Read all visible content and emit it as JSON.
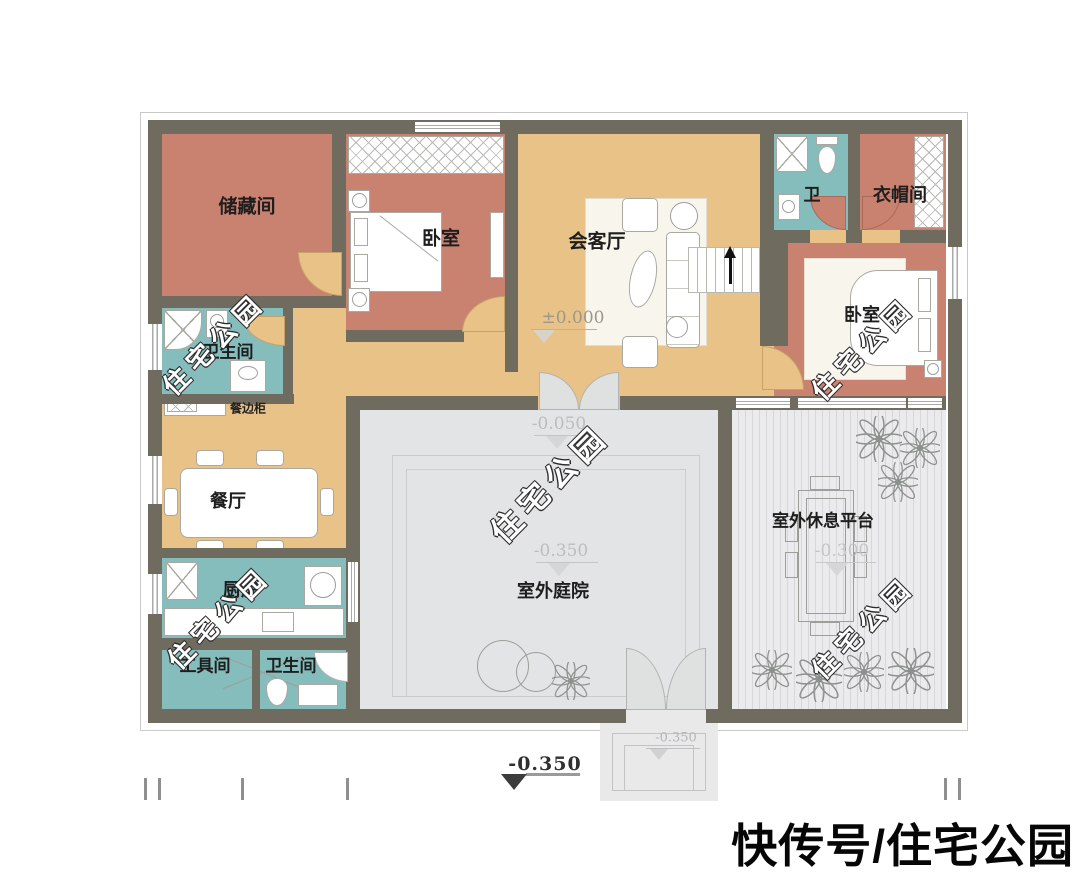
{
  "branding": {
    "text": "快传号/住宅公园"
  },
  "watermark": {
    "text": "住宅公园"
  },
  "rooms": {
    "storage": "储藏间",
    "bedroom1": "卧室",
    "living": "会客厅",
    "bath2": "卫",
    "cloakroom": "衣帽间",
    "bedroom2": "卧室",
    "bath1": "卫生间",
    "sideboard": "餐边柜",
    "dining": "餐厅",
    "kitchen": "厨房",
    "toolroom": "工具间",
    "bath3": "卫生间",
    "courtyard": "室外庭院",
    "platform": "室外休息平台"
  },
  "elevations": {
    "living": "±0.000",
    "court_upper": "-0.050",
    "court_main": "-0.350",
    "platform": "-0.300",
    "porch": "-0.350",
    "site": "-0.350"
  },
  "palette": {
    "wall": "#6f6b5f",
    "hall_tan": "#e9c288",
    "room_salmon": "#c98170",
    "wet_teal": "#85bdbc",
    "outdoor_gray": "#e3e4e6",
    "door_leaf": "#dfe1e0",
    "background": "#ffffff"
  }
}
